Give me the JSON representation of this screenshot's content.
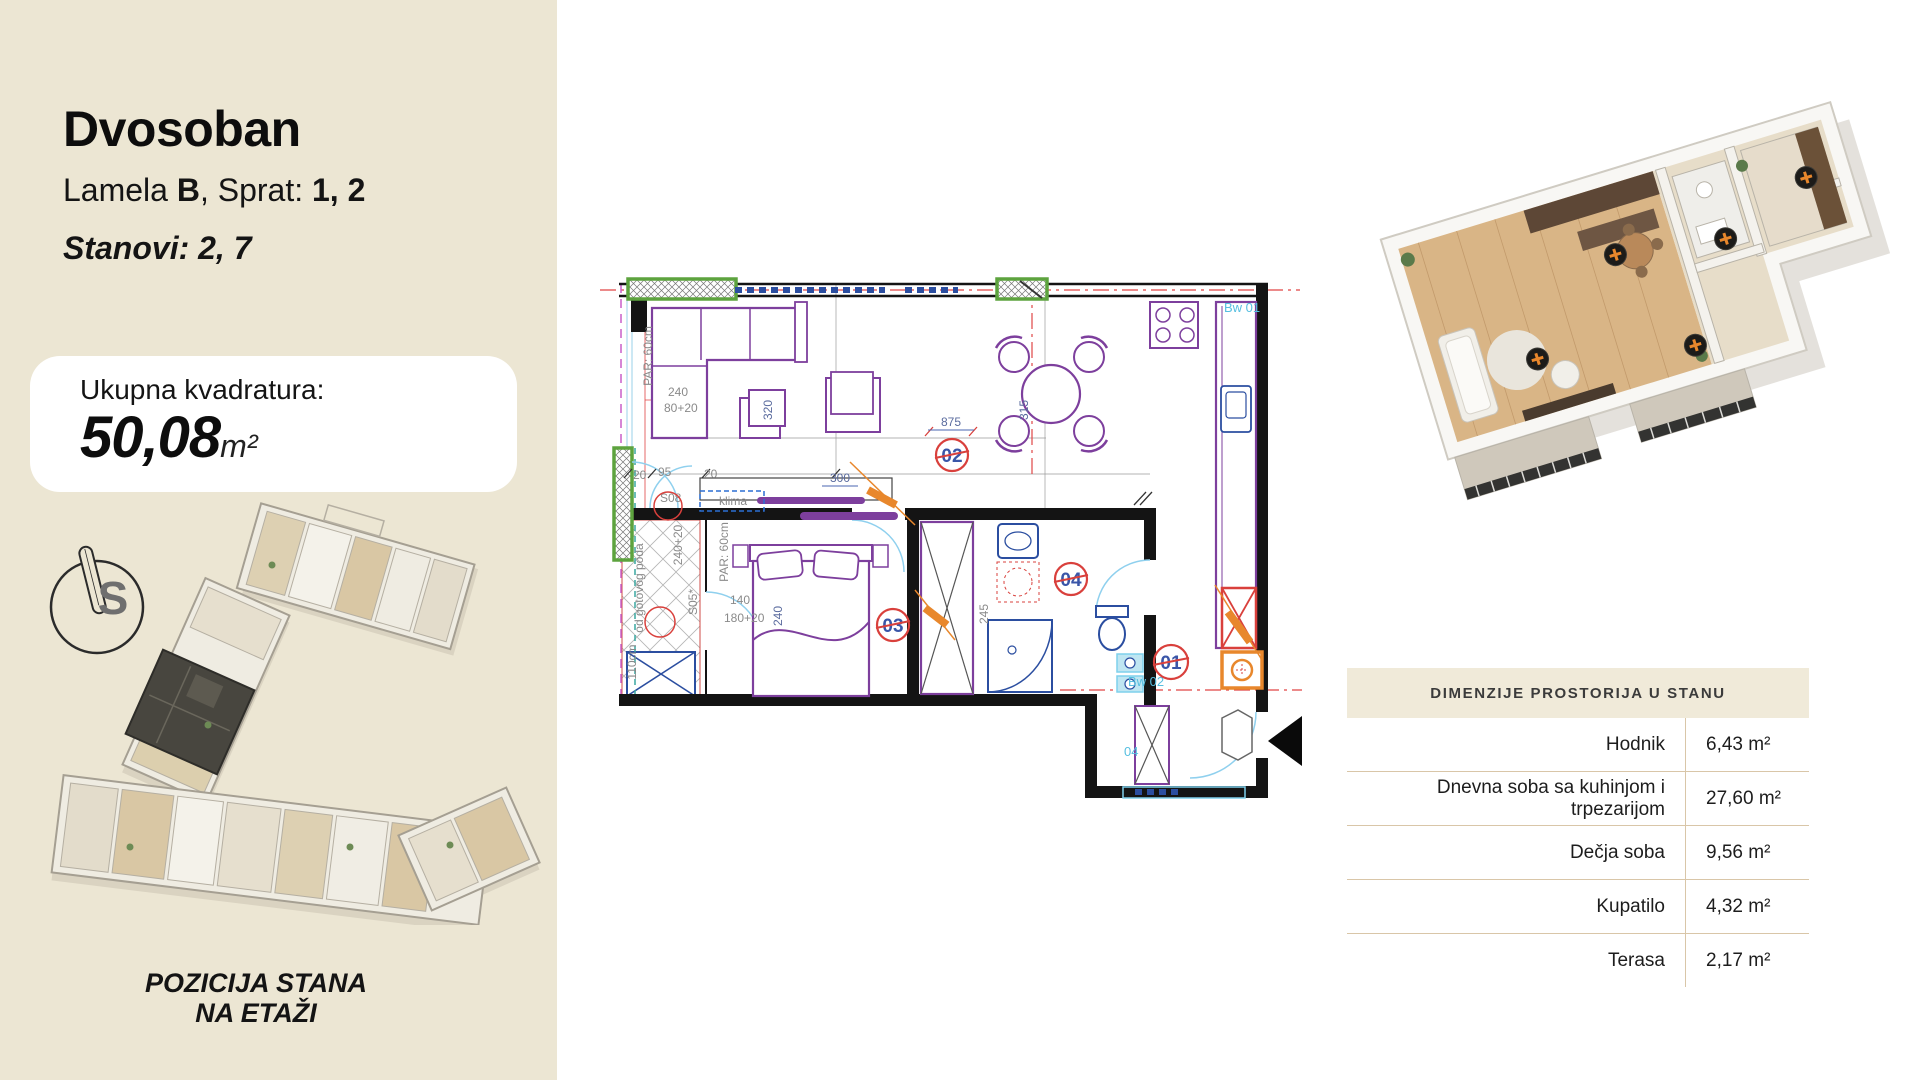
{
  "sidebar": {
    "title": "Dvosoban",
    "subtitle_prefix": "Lamela ",
    "subtitle_lamela": "B",
    "subtitle_mid": ", Sprat: ",
    "subtitle_floors": "1, 2",
    "stanovi": "Stanovi: 2, 7",
    "area_label": "Ukupna kvadratura:",
    "area_value": "50,08",
    "area_unit": "m²",
    "compass_letter": "S",
    "position_caption_line1": "POZICIJA STANA",
    "position_caption_line2": "NA ETAŽI"
  },
  "floor_plan": {
    "rooms": {
      "r01": "01",
      "r02": "02",
      "r03": "03",
      "r04": "04"
    },
    "texts": {
      "par_top": "PAR: 60cm",
      "par_mid": "PAR: 60cm",
      "klima": "klima",
      "s08": "S08",
      "s05": "S05*",
      "od_poda": "od gotovog poda",
      "cm110": "110cm",
      "bw01": "Bw 01",
      "bw02": "Bw 02",
      "bw04": "04",
      "d240": "240",
      "d8020": "80+20",
      "d320": "320",
      "d300": "300",
      "d875": "875",
      "d315": "315",
      "d140": "140",
      "d18020": "180+20",
      "d24020": "240+20",
      "d240b": "240",
      "d245": "245",
      "d20a": "20",
      "d95": "95",
      "d20b": "20"
    }
  },
  "dimensions_table": {
    "title": "DIMENZIJE PROSTORIJA U STANU",
    "rows": [
      {
        "label": "Hodnik",
        "value": "6,43 m²"
      },
      {
        "label": "Dnevna soba sa kuhinjom i trpezarijom",
        "value": "27,60 m²"
      },
      {
        "label": "Dečja soba",
        "value": "9,56 m²"
      },
      {
        "label": "Kupatilo",
        "value": "4,32 m²"
      },
      {
        "label": "Terasa",
        "value": "2,17 m²"
      }
    ]
  },
  "colors": {
    "sidebar_bg": "#ece6d3",
    "table_header_bg": "#f0ead9",
    "table_divider": "#d9c6a8",
    "plan_red": "#d9403c",
    "plan_purple": "#7d3f9d",
    "plan_blue": "#2b4ea0",
    "plan_cyan": "#7fd0ec",
    "plan_green": "#5da33e",
    "plan_orange": "#e8872c",
    "highlight_unit": "#48463f"
  }
}
